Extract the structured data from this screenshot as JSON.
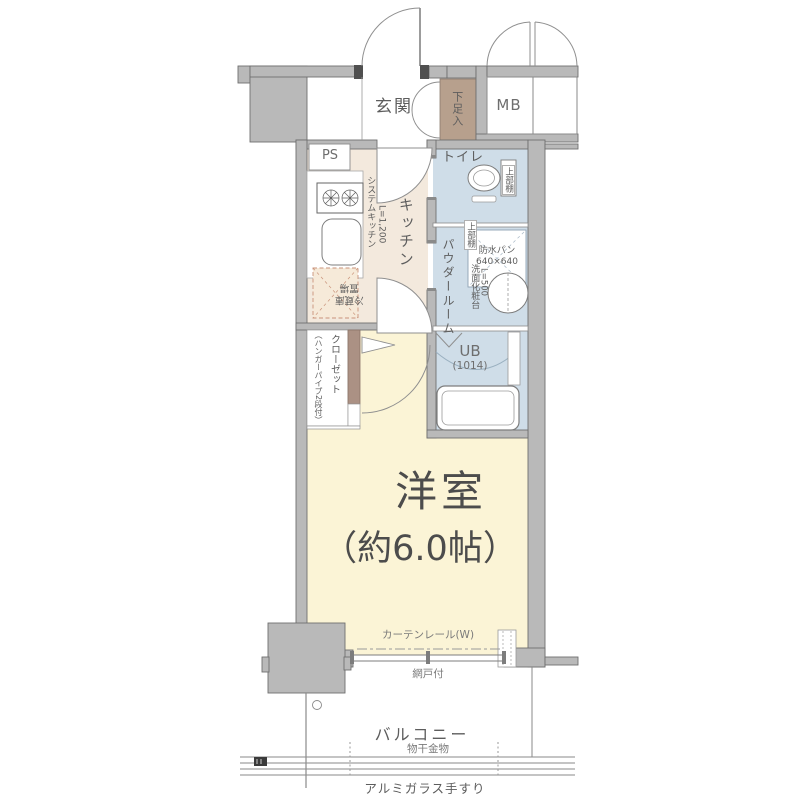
{
  "plan_type": "apartment-floor-plan",
  "labels": {
    "genkan": "玄関",
    "shoe_cabinet": "下足入",
    "meter_box": "MB",
    "pipe_space": "PS",
    "toilet": "トイレ",
    "toilet_upper_shelf": "上部棚",
    "kitchen": "キッチン",
    "system_kitchen": "システムキッチン",
    "system_kitchen_length": "L=1,200",
    "fridge_line1": "冷蔵庫",
    "fridge_line2": "置場",
    "powder_room": "パウダールーム",
    "laundry_upper_shelf": "上部棚",
    "waterproof_pan_line1": "防水パン",
    "waterproof_pan_line2": "640×640",
    "vanity": "洗面化粧台",
    "vanity_length": "L=500",
    "unit_bath": "UB",
    "unit_bath_size": "(1014)",
    "closet": "クローゼット",
    "closet_note": "（ハンガーパイプ2段付）",
    "main_room": "洋室",
    "main_room_size": "（約6.0帖）",
    "curtain_rail": "カーテンレール(W)",
    "screen_door": "網戸付",
    "balcony": "バルコニー",
    "laundry_hardware": "物干金物",
    "handrail": "アルミガラス手すり"
  },
  "colors": {
    "wall_fill": "#b9b9b9",
    "wall_outline": "#6f6f6f",
    "main_room_floor": "#fbf4d6",
    "kitchen_floor": "#f3e9dd",
    "wet_area_floor": "#cfdde8",
    "shoe_cabinet_fill": "#b7a08d",
    "closet_pole_fill": "#ab9184",
    "fridge_space_fill": "#f6ead9",
    "fridge_space_border": "#c9937a",
    "line": "#888888",
    "text": "#5d5d5d"
  }
}
